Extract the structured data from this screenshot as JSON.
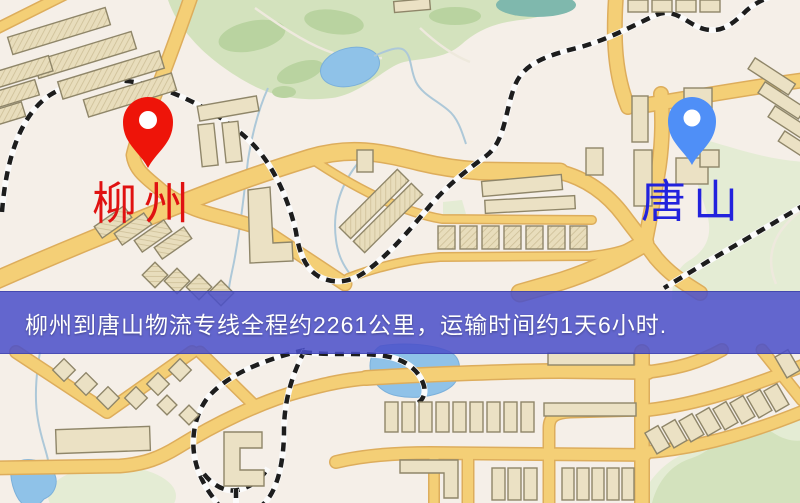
{
  "map": {
    "banner": {
      "text": "柳州到唐山物流专线全程约2261公里，运输时间约1天6小时.",
      "bg_color": "#4a4fca",
      "text_color": "#ffffff"
    },
    "city_from": {
      "label": "柳州",
      "label_color": "#e01111",
      "pin_color": "#ee1409"
    },
    "city_to": {
      "label": "唐山",
      "label_color": "#2222dd",
      "pin_color": "#4f8ff7"
    },
    "route": {
      "distance_km": "2261",
      "duration": "1天6小时"
    },
    "palette": {
      "background": "#f5efe8",
      "road_fill": "#f4cf76",
      "road_casing": "#ddad5c",
      "building": "#ebe1c4",
      "park": "#d3e2bd",
      "water": "#8fc2e8",
      "railway": "#1d1d1d"
    }
  }
}
